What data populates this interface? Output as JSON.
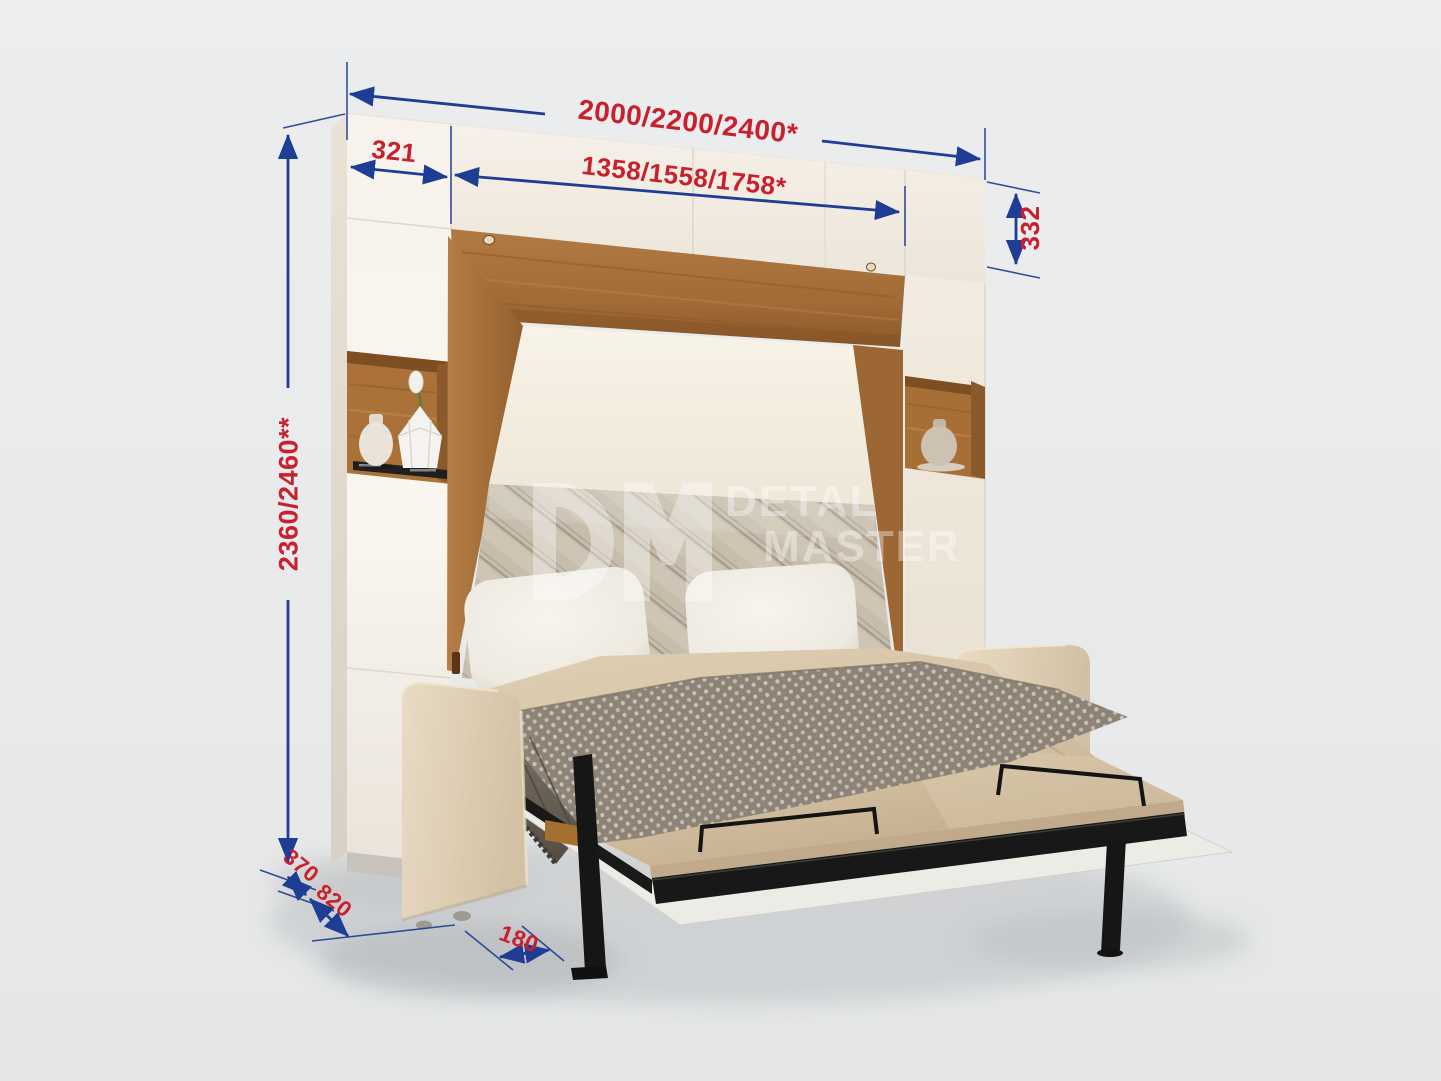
{
  "scene": {
    "type": "furniture dimension diagram",
    "product": "wall bed with sofa and cabinets",
    "background_color": "#e8eaeb",
    "dimension_line_color": "#1e3d93",
    "dimension_label_color": "#c9202e",
    "cabinet_color": "#f6f2ea",
    "wood_color": "#a8713c",
    "sofa_color": "#e4d6bd",
    "bedding_color": "#d7c3a7",
    "metal_color": "#181818"
  },
  "dimensions": {
    "total_width": {
      "label": "2000/2200/2400*"
    },
    "left_section_width": {
      "label": "321"
    },
    "opening_width": {
      "label": "1358/1558/1758*"
    },
    "upper_cabinet_height": {
      "label": "332"
    },
    "total_height": {
      "label": "2360/2460**"
    },
    "cabinet_depth": {
      "label": "370"
    },
    "sofa_depth": {
      "label": "820"
    },
    "leg_inset": {
      "label": "180"
    }
  },
  "watermark": {
    "logo_text": "DM",
    "line1": "DETAL",
    "line2": "MASTER"
  }
}
